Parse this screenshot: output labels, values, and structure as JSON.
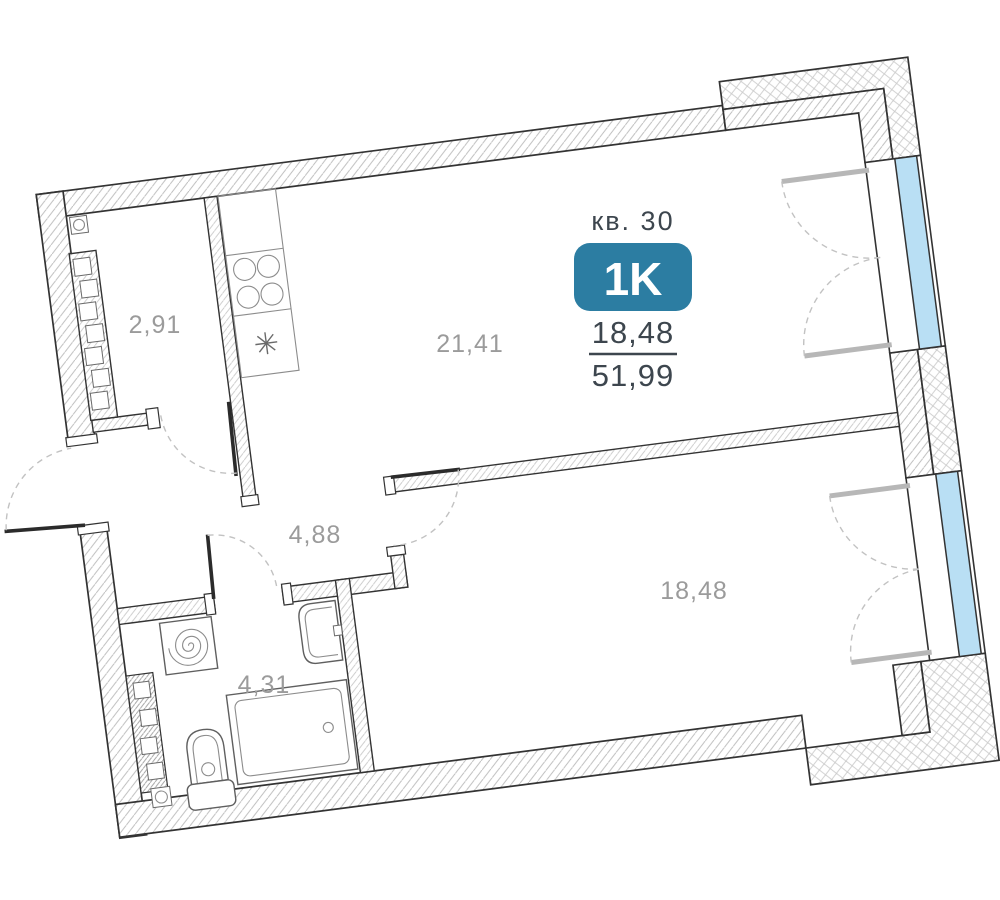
{
  "plan_header": {
    "apartment_label": "кв. 30",
    "type_badge": "1K",
    "living_area": "18,48",
    "total_area": "51,99"
  },
  "room_areas": {
    "wardrobe": "2,91",
    "kitchen_living": "21,41",
    "hallway": "4,88",
    "bathroom": "4,31",
    "bedroom": "18,48"
  },
  "colors": {
    "badge_bg": "#2c7da2",
    "badge_text": "#ffffff",
    "window_glass": "#b9dff4",
    "wall_line": "#333333",
    "room_label": "#9b9b9b",
    "header_text": "#3d464e"
  },
  "icons": [
    "stove-icon",
    "kitchen-sink-icon",
    "washing-machine-icon",
    "bathroom-sink-icon",
    "toilet-icon",
    "bathtub-icon",
    "wardrobe-shelves-icon",
    "vent-duct-icon",
    "window-casement-icon",
    "door-swing-icon"
  ]
}
